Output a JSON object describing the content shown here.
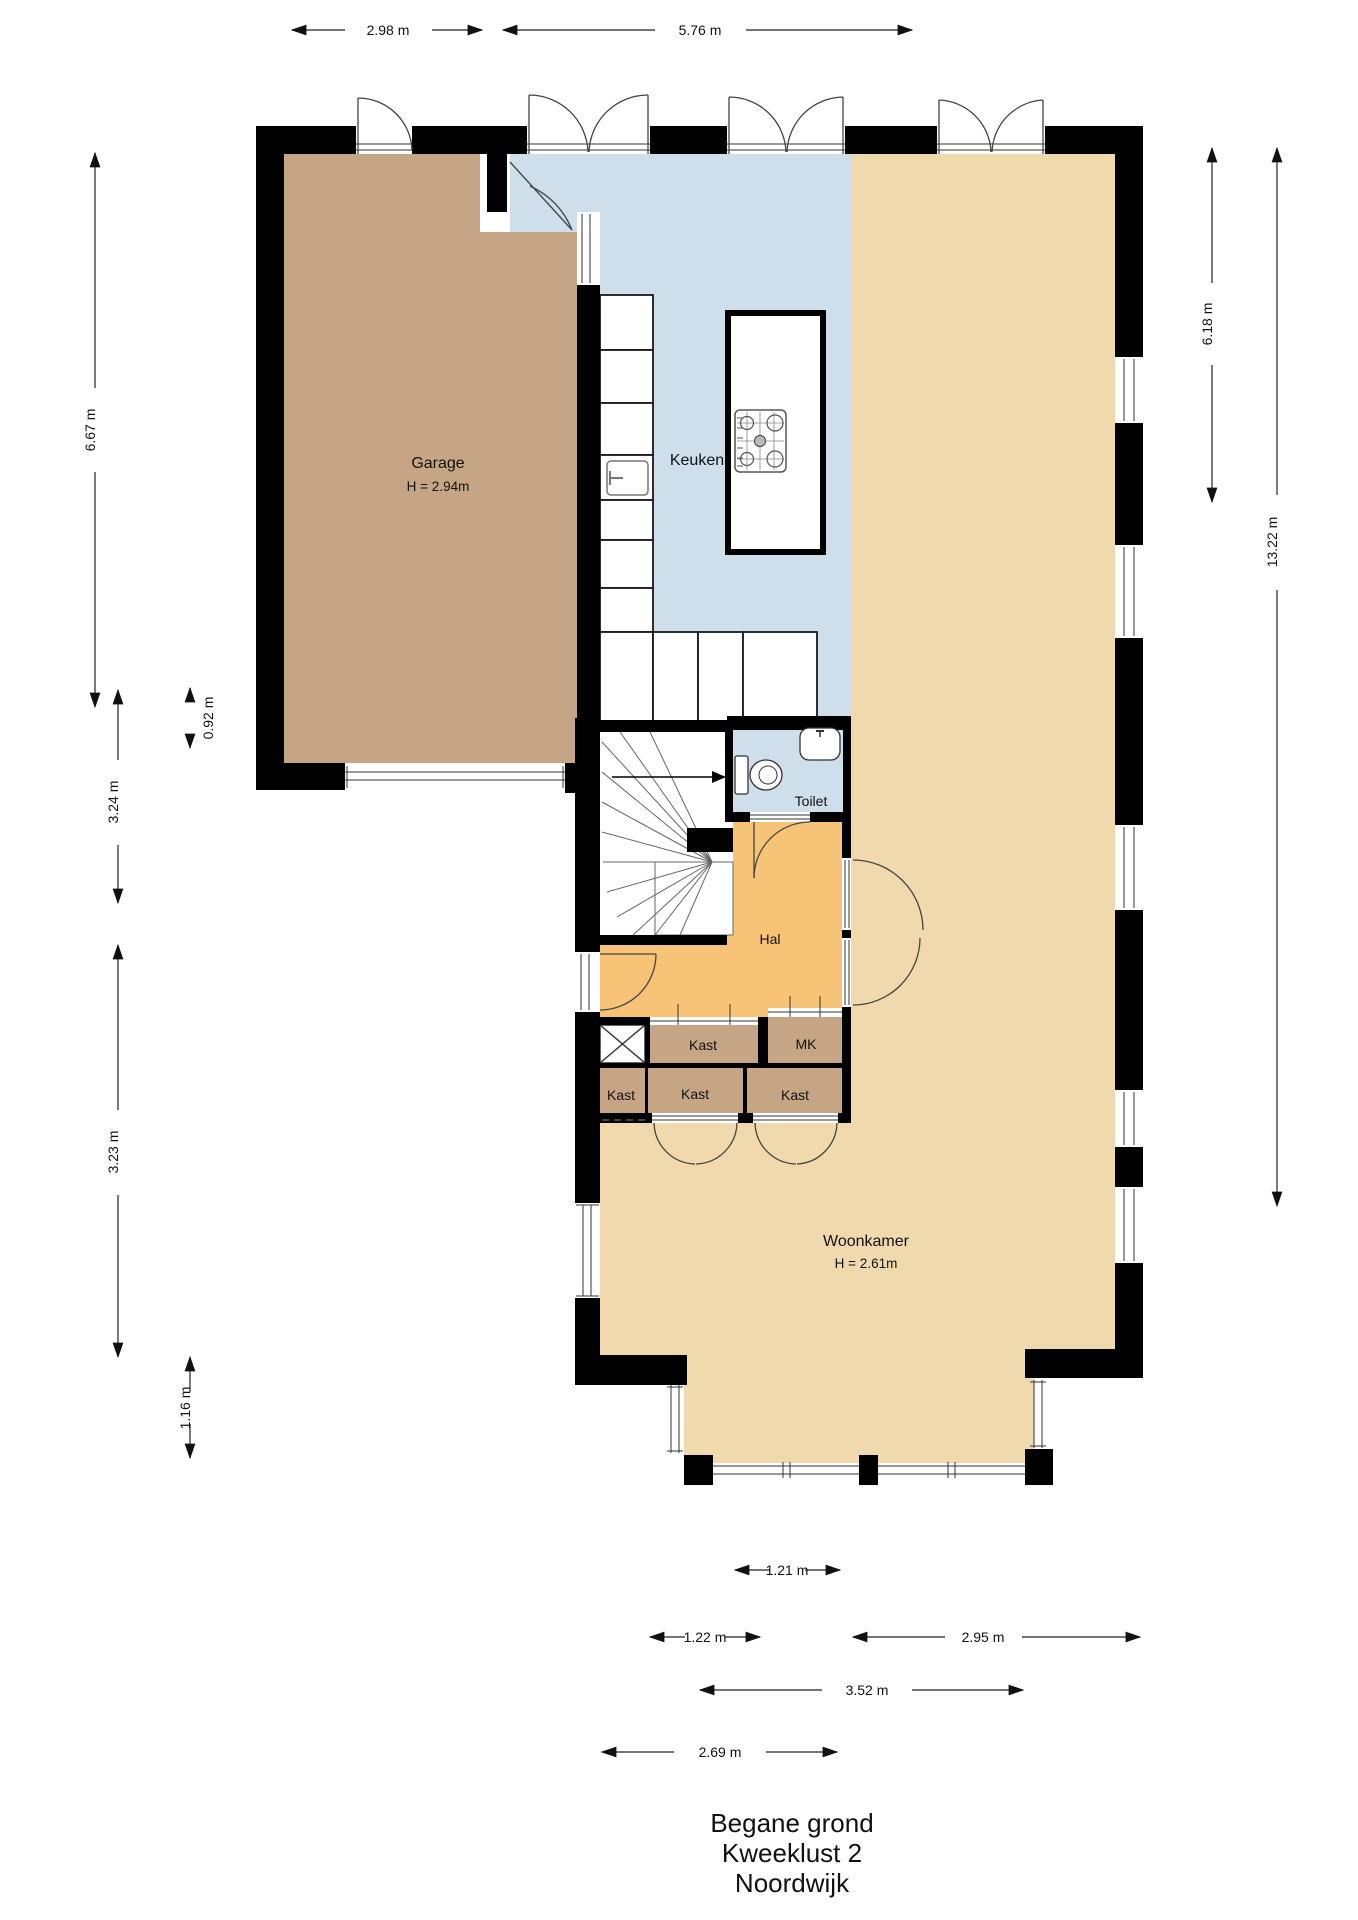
{
  "title": {
    "line1": "Begane grond",
    "line2": "Kweeklust 2",
    "line3": "Noordwijk"
  },
  "rooms": {
    "garage": {
      "label": "Garage",
      "height": "H = 2.94m"
    },
    "keuken": {
      "label": "Keuken"
    },
    "toilet": {
      "label": "Toilet"
    },
    "hal": {
      "label": "Hal"
    },
    "kast_top": {
      "label": "Kast"
    },
    "mk": {
      "label": "MK"
    },
    "kast_left": {
      "label": "Kast"
    },
    "kast_mid": {
      "label": "Kast"
    },
    "kast_right": {
      "label": "Kast"
    },
    "woonkamer": {
      "label": "Woonkamer",
      "height": "H = 2.61m"
    }
  },
  "dimensions": {
    "top": {
      "d1": "2.98 m",
      "d2": "5.76 m"
    },
    "left": {
      "d1": "6.67 m",
      "d2": "0.92 m",
      "d3": "3.24 m",
      "d4": "3.23 m",
      "d5": "1.16 m"
    },
    "right": {
      "d1": "6.18 m",
      "d2": "13.22 m"
    },
    "bottom": {
      "d1": "1.21 m",
      "d2": "1.22 m",
      "d3": "2.95 m",
      "d4": "3.52 m",
      "d5": "2.69 m"
    }
  },
  "colors": {
    "wall": "#000000",
    "garage_floor": "#c6a584",
    "keuken_floor": "#cfdeeb",
    "woonkamer_floor": "#f1d9ae",
    "hal_floor": "#f7c477",
    "kast_floor": "#c6a584",
    "fixtures": "#ffffff"
  }
}
